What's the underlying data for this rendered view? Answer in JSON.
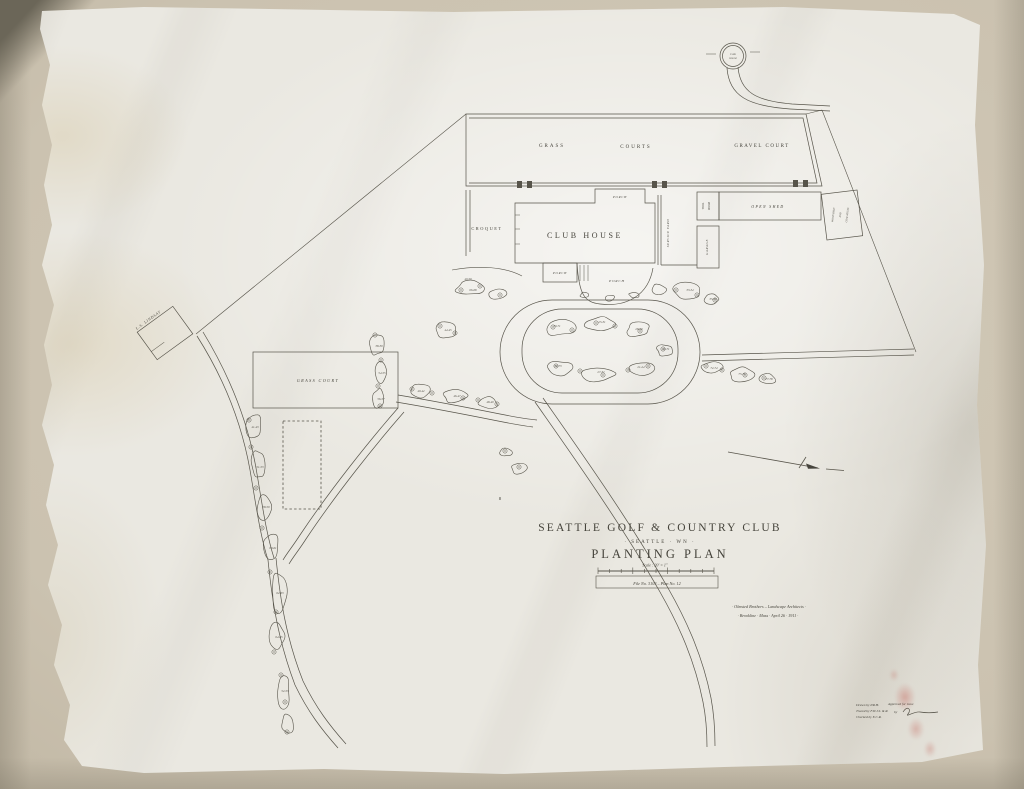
{
  "sheet": {
    "title_block": {
      "club_name": "SEATTLE GOLF & COUNTRY CLUB",
      "location": "· SEATTLE · WN ·",
      "plan_title": "PLANTING PLAN",
      "scale": "Scale : 20' = 1\"",
      "file_no": "File No. 3103 – Plan No. 12"
    },
    "credit": {
      "line1": "· Olmsted Brothers – Landscape Architects ·",
      "line2": "· Brookline · Mass · April 26 · 1911 ·"
    },
    "approval": {
      "drawn_by": "Drawn by P.R.H.",
      "traced_by": "Traced by F.W.J.S. & R.",
      "checked_by": "Checked by E.C.R.",
      "approved_for_issue": "Approved for issue",
      "approved_by": "by"
    },
    "labels": {
      "grass": "GRASS",
      "courts": "COURTS",
      "gravel_court": "GRAVEL COURT",
      "croquet": "CROQUET",
      "club_house": "CLUB HOUSE",
      "porch_top": "PORCH",
      "porch_left": "PORCH",
      "porch_center": "PORCH",
      "service_yard": "SERVICE YARD",
      "garage": "GARAGE",
      "tool_room_1": "TOOL",
      "tool_room_2": "ROOM",
      "open_shed": "OPEN SHED",
      "wood_shed_1": "WOOD SHED",
      "wood_shed_2": "AND",
      "wood_shed_3": "COAL HOUSE",
      "lindsay": "L.S. LINDSAY",
      "grass_court": "GRASS COURT",
      "tank_1": "TANK",
      "tank_2": "HOUSE",
      "b_mark": "B"
    },
    "beds": [
      {
        "label": "41-43",
        "x": 255,
        "y": 428
      },
      {
        "label": "51-53",
        "x": 260,
        "y": 468
      },
      {
        "label": "58-59",
        "x": 266,
        "y": 508
      },
      {
        "label": "60-61",
        "x": 273,
        "y": 549
      },
      {
        "label": "62-63",
        "x": 280,
        "y": 594
      },
      {
        "label": "64-65",
        "x": 279,
        "y": 638
      },
      {
        "label": "52-53",
        "x": 285,
        "y": 692
      },
      {
        "label": "38-39",
        "x": 379,
        "y": 347
      },
      {
        "label": "54-55",
        "x": 382,
        "y": 374
      },
      {
        "label": "56-57",
        "x": 381,
        "y": 400
      },
      {
        "label": "40-42",
        "x": 421,
        "y": 392
      },
      {
        "label": "46-47",
        "x": 457,
        "y": 397
      },
      {
        "label": "48-49",
        "x": 490,
        "y": 403
      },
      {
        "label": "44-45",
        "x": 448,
        "y": 331
      },
      {
        "label": "49-50",
        "x": 468,
        "y": 280
      },
      {
        "label": "66-68",
        "x": 473,
        "y": 291
      },
      {
        "label": "33-34",
        "x": 690,
        "y": 291
      },
      {
        "label": "35-36",
        "x": 713,
        "y": 300
      },
      {
        "label": "72-74",
        "x": 714,
        "y": 369
      },
      {
        "label": "75-76",
        "x": 742,
        "y": 375
      },
      {
        "label": "77-78",
        "x": 769,
        "y": 380
      },
      {
        "label": "70-71",
        "x": 557,
        "y": 327
      },
      {
        "label": "25-31",
        "x": 602,
        "y": 323
      },
      {
        "label": "28-29",
        "x": 639,
        "y": 330
      },
      {
        "label": "72-73",
        "x": 558,
        "y": 367
      },
      {
        "label": "27-32",
        "x": 601,
        "y": 373
      },
      {
        "label": "21-24",
        "x": 641,
        "y": 368
      },
      {
        "label": "69-71",
        "x": 666,
        "y": 350
      }
    ]
  }
}
